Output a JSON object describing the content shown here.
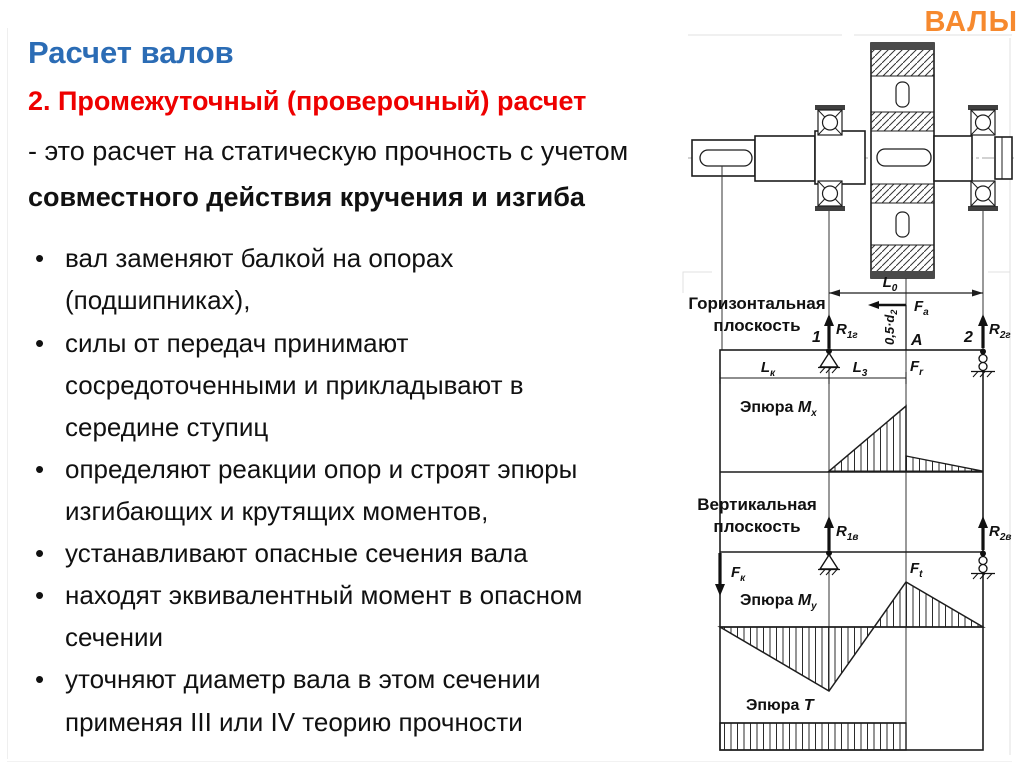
{
  "slide": {
    "watermark": "ВАЛЫ",
    "title": "Расчет валов",
    "subtitle": "2. Промежуточный (проверочный) расчет",
    "intro1": "- это расчет на статическую прочность с учетом",
    "intro2": "совместного действия кручения и изгиба",
    "bullets": [
      "вал заменяют балкой на опорах (подшипниках),",
      "силы от передач принимают сосредоточенными и прикладывают в середине ступиц",
      "определяют реакции опор и строят эпюры изгибающих и крутящих моментов,",
      "устанавливают опасные сечения вала",
      "находят эквивалентный момент в опасном сечении",
      "уточняют диаметр вала в этом сечении применяя III или IV теорию прочности"
    ],
    "colors": {
      "title_blue": "#2B6CB5",
      "heading_red": "#EE0000",
      "watermark_orange": "#F6892E",
      "body_text": "#111111",
      "diagram_line": "#1d1d1d"
    }
  },
  "diagram": {
    "plane_h1": "Горизонтальная",
    "plane_h2": "плоскость",
    "plane_v1": "Вертикальная",
    "plane_v2": "плоскость",
    "epure_word": "Эпюра ",
    "mx": {
      "main": "M",
      "sub": "x"
    },
    "my": {
      "main": "M",
      "sub": "y"
    },
    "t": {
      "main": "T",
      "sub": ""
    },
    "labels": {
      "l0": {
        "main": "L",
        "sub": "0"
      },
      "lk": {
        "main": "L",
        "sub": "к"
      },
      "l3": {
        "main": "L",
        "sub": "3"
      },
      "fa": {
        "main": "F",
        "sub": "а"
      },
      "fr": {
        "main": "F",
        "sub": "r"
      },
      "ft": {
        "main": "F",
        "sub": "t"
      },
      "fk": {
        "main": "F",
        "sub": "к"
      },
      "r1g": {
        "main": "R",
        "sub": "1г"
      },
      "r2g": {
        "main": "R",
        "sub": "2г"
      },
      "r1v": {
        "main": "R",
        "sub": "1в"
      },
      "r2v": {
        "main": "R",
        "sub": "2в"
      },
      "half_d": {
        "main": "0,5·d",
        "sub": "2"
      },
      "support1": "1",
      "support2": "2",
      "point_a": "A"
    }
  }
}
